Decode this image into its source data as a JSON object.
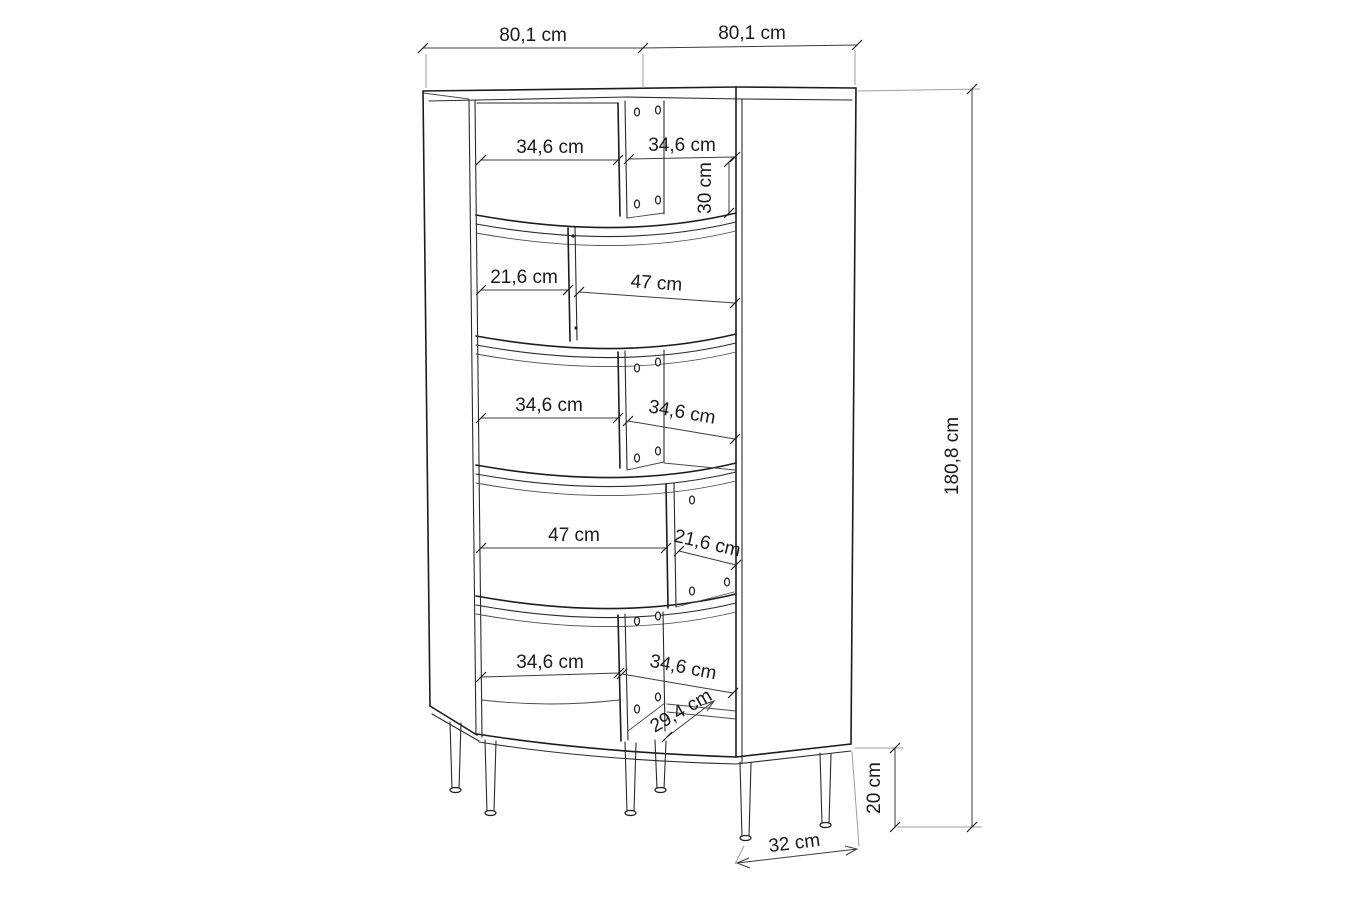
{
  "drawing": {
    "type": "furniture-technical-drawing",
    "object": "curved corner bookcase front view with dimension lines",
    "line_color": "#1c1c1c",
    "dim_line_color": "#3c3c3c",
    "extension_line_color": "#9d9d9d",
    "background_color": "#ffffff"
  },
  "dims": {
    "top_left_width": "80,1 cm",
    "top_right_width": "80,1 cm",
    "total_height": "180,8 cm",
    "leg_height": "20 cm",
    "base_depth": "32 cm",
    "s1_left_width": "34,6 cm",
    "s1_right_width": "34,6 cm",
    "s1_compartment_height": "30 cm",
    "s2_left_width": "21,6 cm",
    "s2_right_width": "47 cm",
    "s3_left_width": "34,6 cm",
    "s3_right_width": "34,6 cm",
    "s4_left_width": "47 cm",
    "s4_right_width": "21,6 cm",
    "s5_left_width": "34,6 cm",
    "s5_right_width": "34,6 cm",
    "s5_diagonal_depth": "29,4 cm"
  }
}
